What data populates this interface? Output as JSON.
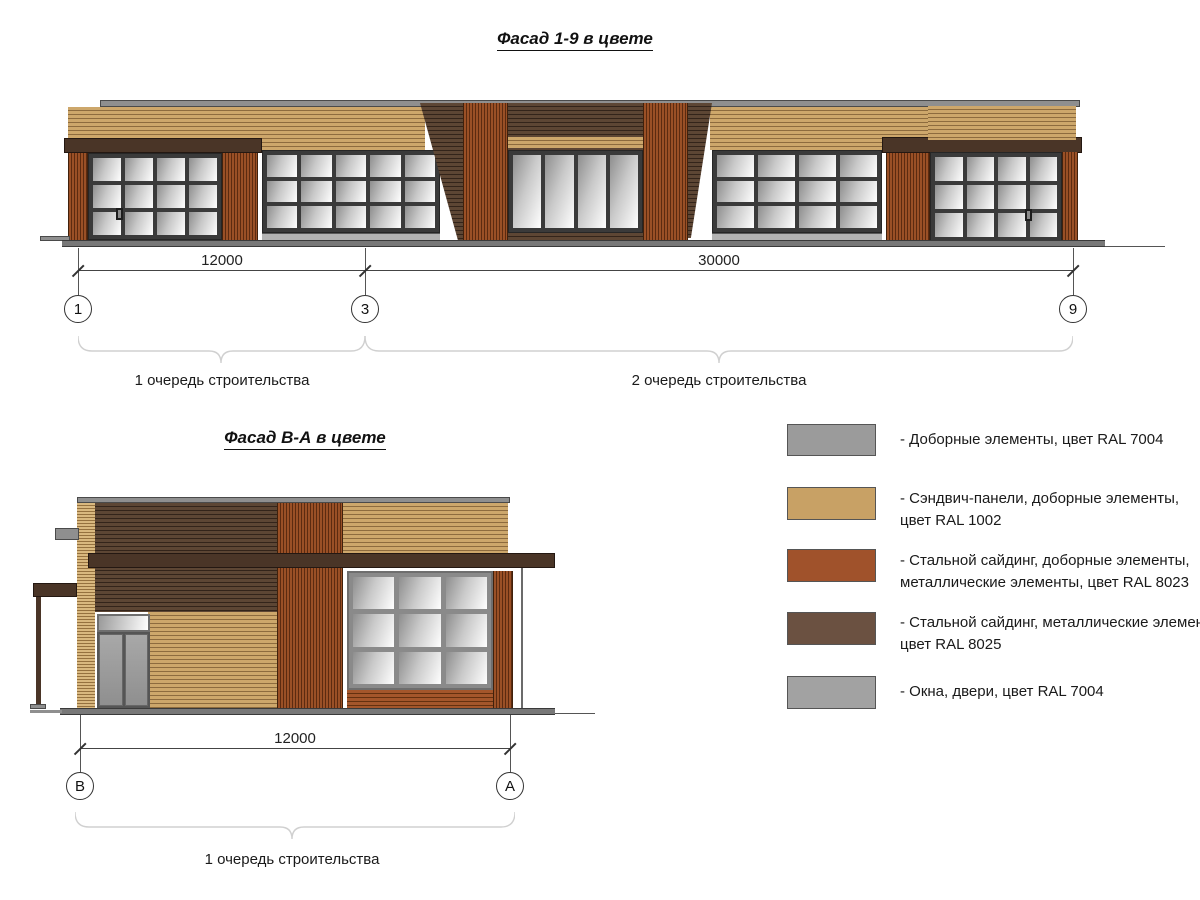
{
  "facade1": {
    "title": "Фасад 1-9 в цвете",
    "dim_labels": [
      "12000",
      "30000"
    ],
    "axis_labels": [
      "1",
      "3",
      "9"
    ],
    "phase_labels": [
      "1 очередь строительства",
      "2 очередь строительства"
    ]
  },
  "facade2": {
    "title": "Фасад В-А в цвете",
    "dim_labels": [
      "12000"
    ],
    "axis_labels": [
      "В",
      "А"
    ],
    "phase_labels": [
      "1 очередь строительства"
    ]
  },
  "legend": {
    "items": [
      {
        "color": "#9b9b9b",
        "line1": "- Доборные элементы, цвет RAL 7004",
        "line2": ""
      },
      {
        "color": "#c8a165",
        "line1": "- Сэндвич-панели, доборные элементы,",
        "line2": "цвет RAL 1002"
      },
      {
        "color": "#a0522b",
        "line1": "- Стальной сайдинг, доборные элементы,",
        "line2": "металлические элементы, цвет RAL 8023"
      },
      {
        "color": "#6b5141",
        "line1": "- Стальной сайдинг, металлические элемен",
        "line2": "цвет RAL 8025"
      },
      {
        "color": "#a2a2a2",
        "line1": "- Окна, двери, цвет RAL 7004",
        "line2": ""
      }
    ]
  },
  "materials": {
    "ral_7004_gray": "#9b9b9b",
    "ral_1002_sand": "#c8a165",
    "ral_8023_orange_brown": "#a0522b",
    "ral_8025_pale_brown": "#6b5141",
    "window_door_gray": "#a2a2a2"
  }
}
